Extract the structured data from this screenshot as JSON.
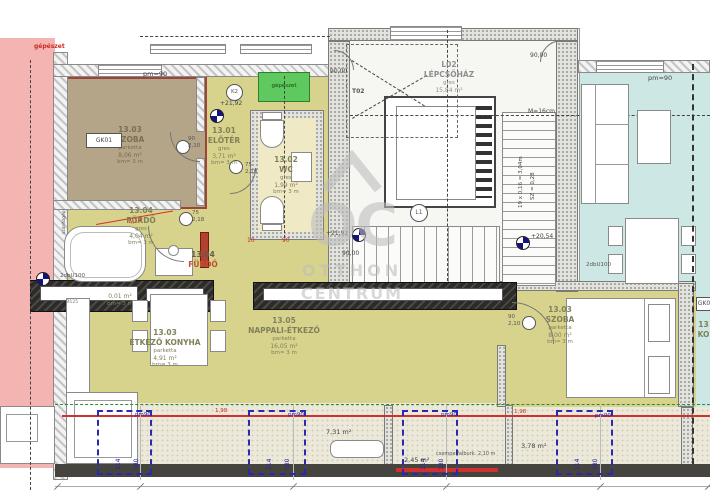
{
  "watermark": {
    "initials": "OC",
    "line1": "OTTHON",
    "line2": "CENTRUM"
  },
  "rooms": {
    "szoba1": {
      "id": "13.03",
      "name": "SZOBA",
      "finish": "parketta",
      "area": "8,06 m²",
      "height": "bm= 3 m"
    },
    "eloter": {
      "id": "13.01",
      "name": "ELŐTÉR",
      "finish": "gres",
      "area": "3,71 m²",
      "height": "bm= 3 m"
    },
    "wc": {
      "id": "13.02",
      "name": "WC",
      "finish": "gres",
      "area": "1,99 m²",
      "height": "bm= 3 m"
    },
    "furdo": {
      "id": "13.04",
      "name": "FÜRDŐ",
      "finish": "gres",
      "area": "4,04 m²",
      "height": "bm= 3 m"
    },
    "furdo2": {
      "id": "13.04",
      "name": "FÜRDŐ"
    },
    "nappali": {
      "id": "13.05",
      "name": "NAPPALI-ÉTKEZŐ",
      "finish": "parketta",
      "area": "16,05 m²",
      "height": "bm= 3 m"
    },
    "konyha": {
      "id": "13.03",
      "name": "ÉTKEZŐ KONYHA",
      "finish": "parketta",
      "area": "4,91 m²",
      "height": "bm= 3 m"
    },
    "szoba2": {
      "id": "13.03",
      "name": "SZOBA",
      "finish": "parketta",
      "area": "8,00 m²",
      "height": "bm= 3 m"
    },
    "lepcso": {
      "id": "L02",
      "name": "LÉPCSŐHÁZ",
      "finish": "gres",
      "area": "15,84 m²"
    },
    "hidden": {
      "area": "0,01 m²",
      "height": "bm= 3 m"
    },
    "neighbor": {
      "id": "13",
      "name": "KO"
    }
  },
  "stairs": {
    "steps": "19 x 0,16 = 3,04m",
    "tread": "SZ = 0,28",
    "scale": "M=16cm",
    "lift": "L1",
    "zone": "T02"
  },
  "levels": {
    "a": "+21,92",
    "b": "+21,92",
    "c": "+20,54",
    "k2": "K2"
  },
  "angles": {
    "a": "90,00",
    "b": "90,00",
    "c": "90,00"
  },
  "doors": {
    "w90": "90",
    "h210": "2,10",
    "w75": "75",
    "h218": "2,18"
  },
  "dims": {
    "red10": "10",
    "red90": "90",
    "red414": "4,14",
    "red198": "1,98",
    "pm90": "pm=90",
    "pm90s": "pm90",
    "w114": "114",
    "h180": "180"
  },
  "terrace": {
    "area1": "7,31 m²",
    "area2": "2,45 m²",
    "area3": "3,78 m²",
    "tile": "csempe falburk. 2,10 m"
  },
  "labels": {
    "gepeszet": "gépészet",
    "gepeszet_box": "gépészet",
    "gk01": "GK01",
    "gk_right": "GK0",
    "u100": "2dbU100",
    "szarito": "szárítógép",
    "pipe": "Ø125"
  }
}
